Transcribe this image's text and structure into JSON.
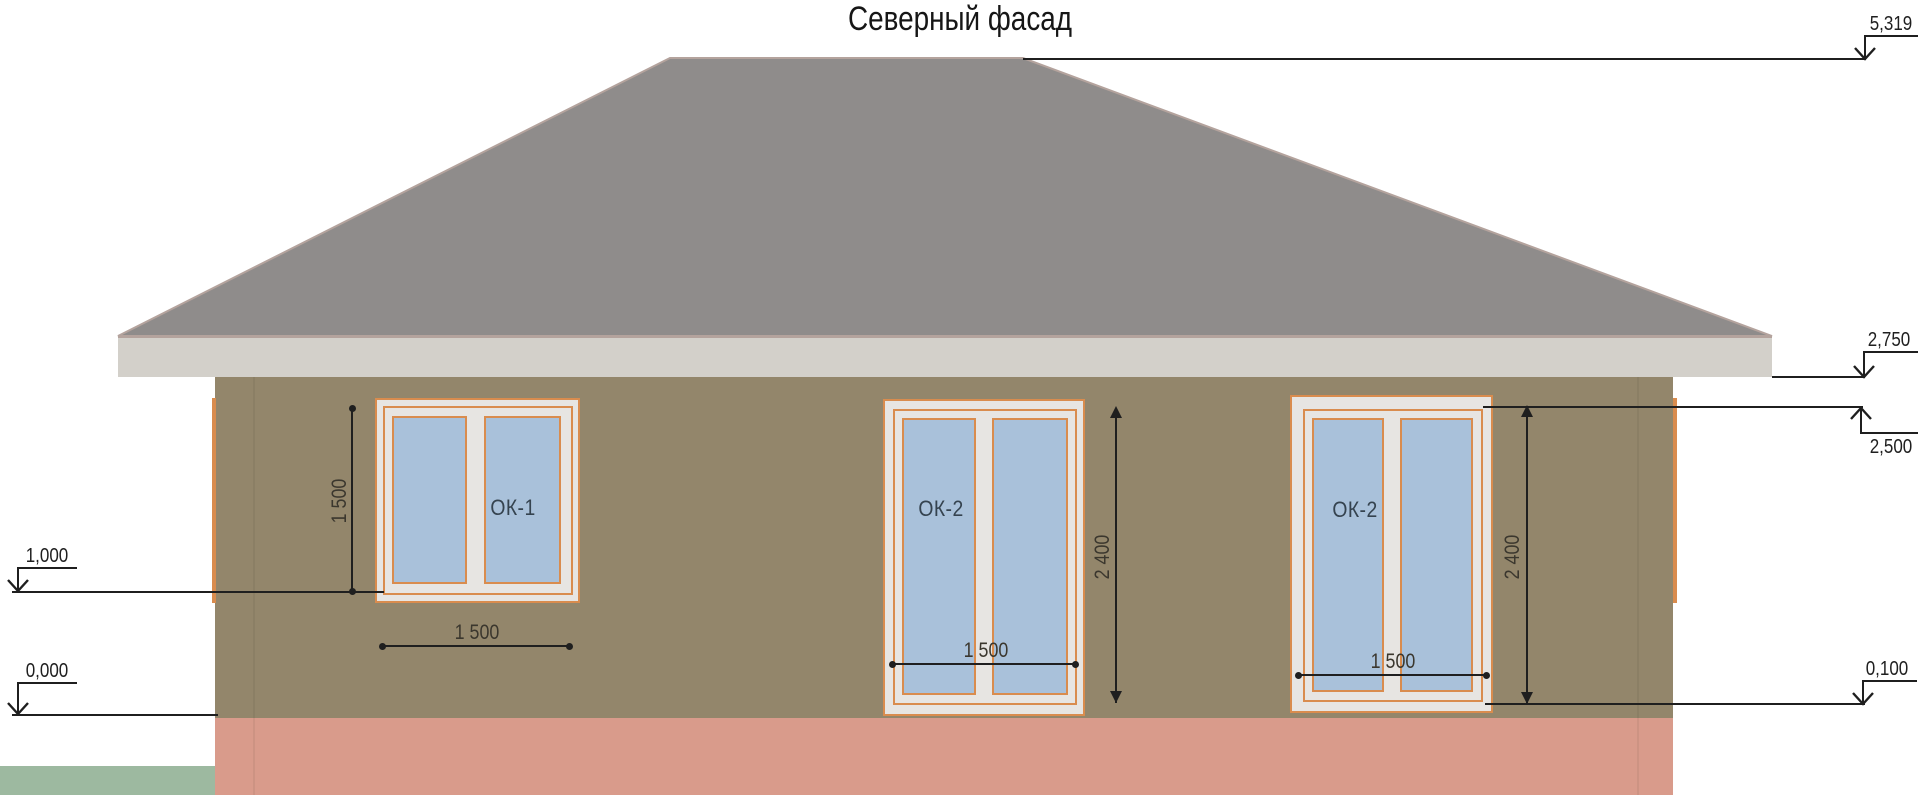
{
  "title": "Северный фасад",
  "windows": [
    {
      "label": "ОК-1",
      "width_dim": "1 500",
      "height_dim": "1 500"
    },
    {
      "label": "ОК-2",
      "width_dim": "1 500",
      "height_dim": "2 400"
    },
    {
      "label": "ОК-2",
      "width_dim": "1 500",
      "height_dim": "2 400"
    }
  ],
  "levels": {
    "ridge": "5,319",
    "eave": "2,750",
    "window_head": "2,500",
    "ok1_sill": "1,000",
    "ok2_sill": "0,100",
    "ground_floor": "0,000"
  },
  "colors": {
    "roof": "#8f8c8b",
    "roofedge": "#b4a39d",
    "fascia": "#d3d0ca",
    "wall": "#93866b",
    "plinth": "#d99b8b",
    "ground": "#9db9a0",
    "glass": "#a9c1da",
    "trimfill": "#e7e5e2",
    "trimline": "#d98c4e",
    "winlabel": "#35434f",
    "dimtext": "#3b372e",
    "line": "#1f1f1f"
  }
}
